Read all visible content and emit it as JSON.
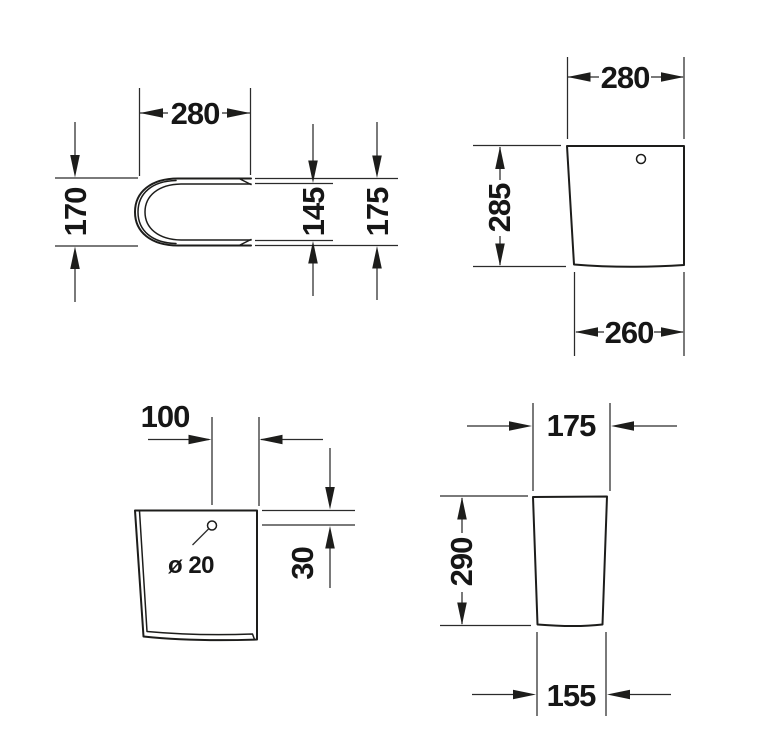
{
  "drawing": {
    "background": "#ffffff",
    "ink": "#1d1d1b",
    "views": {
      "top_view": {
        "dims": {
          "width": "280",
          "left_height": "170",
          "inner_height": "145",
          "outer_height": "175"
        }
      },
      "side_view": {
        "dims": {
          "top_width": "280",
          "height": "285",
          "bottom_width": "260"
        }
      },
      "back_view": {
        "dims": {
          "hole_offset": "100",
          "hole_diameter": "ø 20",
          "hole_top_distance": "30"
        }
      },
      "front_view": {
        "dims": {
          "top_width": "175",
          "height": "290",
          "bottom_width": "155"
        }
      }
    }
  }
}
